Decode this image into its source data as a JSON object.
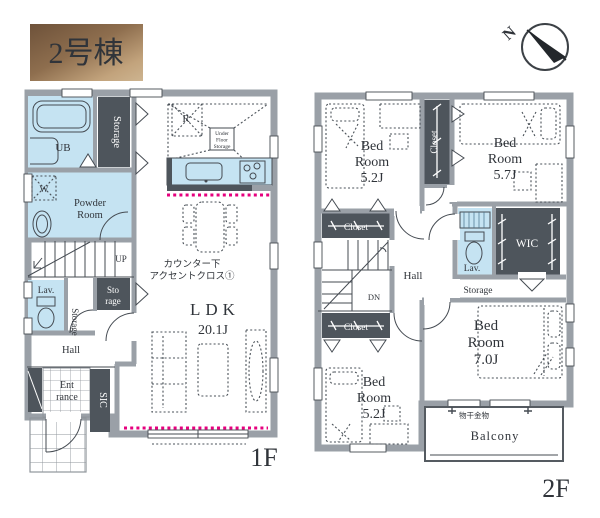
{
  "badge": {
    "label": "2号棟"
  },
  "compass": {
    "north_label": "N"
  },
  "floor1": {
    "floor_label": "1F",
    "ub_label": "UB",
    "storage_top_label": "Storage",
    "powder_line1": "Powder",
    "powder_line2": "Room",
    "washer_label": "W",
    "fridge_label": "R",
    "ufs_line1": "Under",
    "ufs_line2": "Floor",
    "ufs_line3": "Storage",
    "note_line1": "カウンター下",
    "note_line2": "アクセントクロス①",
    "ldk_label": "LDK",
    "ldk_size": "20.1J",
    "up_label": "UP",
    "lav_label": "Lav.",
    "storage_mid_label": "Storage",
    "storage_box_line1": "Sto",
    "storage_box_line2": "rage",
    "hall_label": "Hall",
    "entrance_line1": "Ent",
    "entrance_line2": "rance",
    "sic_label": "SIC"
  },
  "floor2": {
    "floor_label": "2F",
    "bedroom_nw": {
      "line1": "Bed",
      "line2": "Room",
      "size": "5.2J"
    },
    "bedroom_ne": {
      "line1": "Bed",
      "line2": "Room",
      "size": "5.7J"
    },
    "bedroom_se": {
      "line1": "Bed",
      "line2": "Room",
      "size": "7.0J"
    },
    "bedroom_sw": {
      "line1": "Bed",
      "line2": "Room",
      "size": "5.2J"
    },
    "closet_top_label": "Closet",
    "closet_mid_label": "Closet",
    "closet_bottom_label": "Closet",
    "dn_label": "DN",
    "hall_label": "Hall",
    "lav_label": "Lav.",
    "wic_label": "WIC",
    "storage_label": "Storage",
    "laundry_label": "物干金物",
    "balcony_label": "Balcony"
  },
  "colors": {
    "accent_magenta": "#e6007e",
    "wet_area": "#c5e3f2",
    "closet_dark": "#4e555c",
    "wall_gray": "#9aa0a7",
    "badge_dark": "#6e523a",
    "badge_light": "#cdb490"
  }
}
